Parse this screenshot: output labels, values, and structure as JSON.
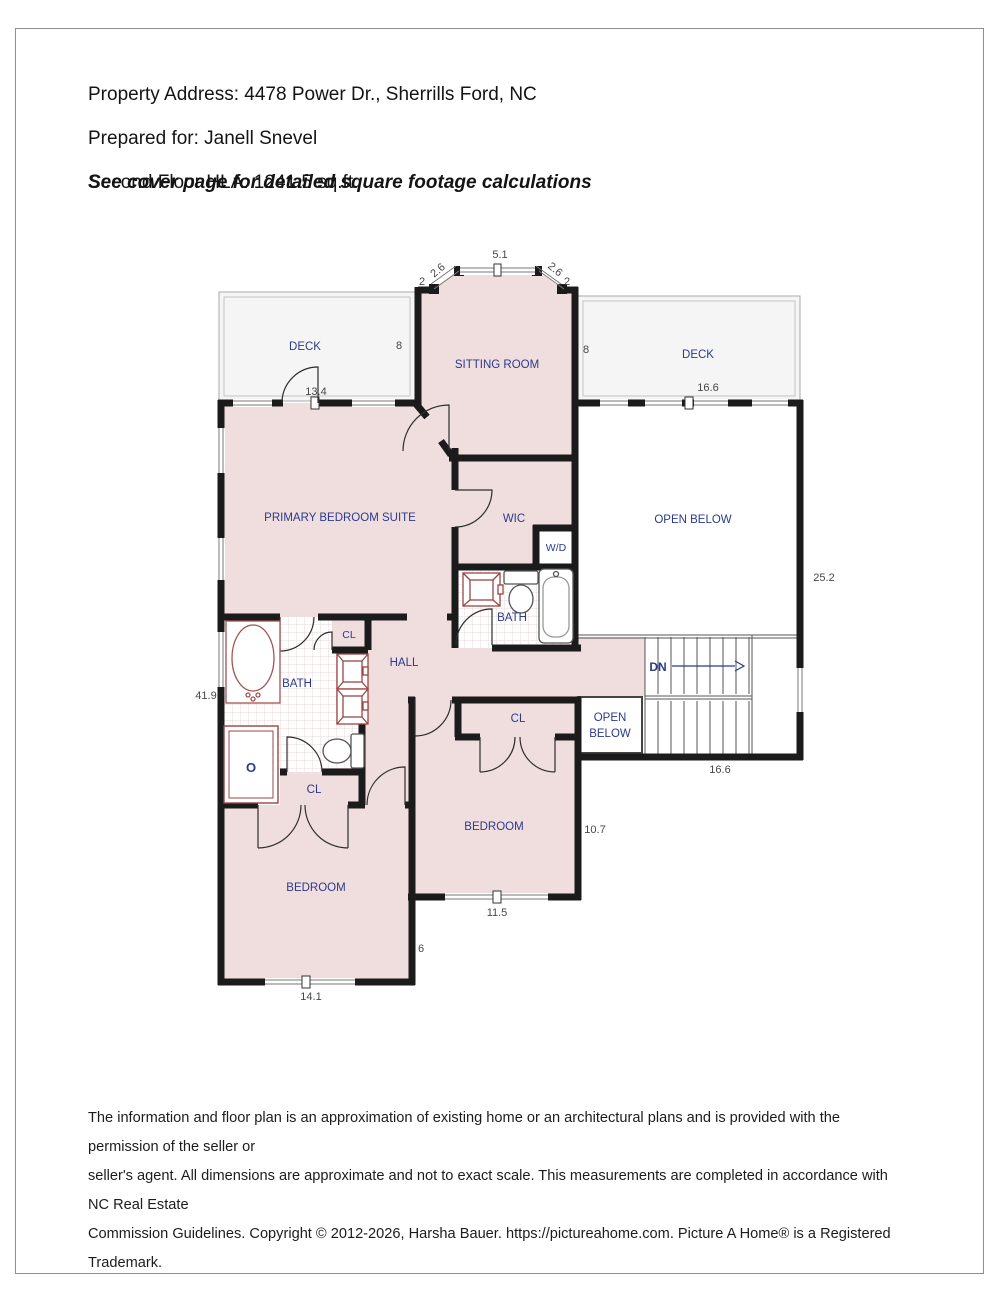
{
  "header": {
    "line1": "Property Address: 4478 Power Dr., Sherrills Ford, NC",
    "line2": "Prepared for: Janell Snevel",
    "line3": "Second Floor HLA: 1241.5 sq.ft.",
    "note": "See cover page for detailed square footage calculations"
  },
  "footer": {
    "line1": "The information and floor plan is an approximation of existing home or an architectural plans and is provided with the permission of the seller or",
    "line2": "seller's agent. All dimensions are approximate and not to exact scale.  This measurements are completed in accordance with NC Real Estate",
    "line3": "Commission Guidelines. Copyright © 2012-2026, Harsha Bauer. https://pictureahome.com. Picture A Home® is a Registered Trademark."
  },
  "floorplan": {
    "colors": {
      "room_fill": "#f0dede",
      "deck_fill": "#f5f5f5",
      "wall": "#1b1b1b",
      "room_label": "#2b3a8c",
      "dimension_label": "#474747",
      "fixture_accent": "#9b4444"
    },
    "room_labels": [
      {
        "id": "deck-left",
        "text": "DECK",
        "x": 305,
        "y": 350
      },
      {
        "id": "sitting-room",
        "text": "SITTING ROOM",
        "x": 497,
        "y": 368
      },
      {
        "id": "deck-right",
        "text": "DECK",
        "x": 698,
        "y": 358
      },
      {
        "id": "primary-bedroom-suite",
        "text": "PRIMARY BEDROOM SUITE",
        "x": 340,
        "y": 521
      },
      {
        "id": "wic",
        "text": "WIC",
        "x": 514,
        "y": 522
      },
      {
        "id": "wd",
        "text": "W/D",
        "x": 556,
        "y": 551,
        "size": 10.5
      },
      {
        "id": "open-below",
        "text": "OPEN BELOW",
        "x": 693,
        "y": 523
      },
      {
        "id": "bath-hall",
        "text": "BATH",
        "x": 512,
        "y": 621
      },
      {
        "id": "hall",
        "text": "HALL",
        "x": 404,
        "y": 666
      },
      {
        "id": "cl-bath",
        "text": "CL",
        "x": 349,
        "y": 638,
        "size": 10.5
      },
      {
        "id": "bath-primary",
        "text": "BATH",
        "x": 297,
        "y": 687
      },
      {
        "id": "dn",
        "text": "DN",
        "x": 658,
        "y": 671,
        "bold": true,
        "size": 12
      },
      {
        "id": "open-below-small-line1",
        "text": "OPEN",
        "x": 610,
        "y": 721
      },
      {
        "id": "open-below-small-line2",
        "text": "BELOW",
        "x": 610,
        "y": 737
      },
      {
        "id": "cl-bedroom-mid",
        "text": "CL",
        "x": 518,
        "y": 722
      },
      {
        "id": "cl-bedroom-left",
        "text": "CL",
        "x": 314,
        "y": 793
      },
      {
        "id": "bedroom-mid",
        "text": "BEDROOM",
        "x": 494,
        "y": 830
      },
      {
        "id": "bedroom-left",
        "text": "BEDROOM",
        "x": 316,
        "y": 891
      },
      {
        "id": "shower-drain",
        "text": "O",
        "x": 251,
        "y": 772,
        "color": "#9b4444",
        "bold": true,
        "size": 13
      }
    ],
    "dimension_labels": [
      {
        "id": "dim-bay-width",
        "text": "5.1",
        "x": 500,
        "y": 258
      },
      {
        "id": "dim-bay-diag-left",
        "text": "2.6",
        "x": 440,
        "y": 273,
        "rotate": -40
      },
      {
        "id": "dim-bay-diag-right",
        "text": "2.6",
        "x": 553,
        "y": 272,
        "rotate": 40
      },
      {
        "id": "dim-bay-stub-left",
        "text": "2",
        "x": 422,
        "y": 285
      },
      {
        "id": "dim-bay-stub-right",
        "text": "2",
        "x": 567,
        "y": 285
      },
      {
        "id": "dim-sitting-left",
        "text": "8",
        "x": 399,
        "y": 349
      },
      {
        "id": "dim-sitting-right",
        "text": "8",
        "x": 586,
        "y": 353
      },
      {
        "id": "dim-deck-left-width",
        "text": "13.4",
        "x": 316,
        "y": 395
      },
      {
        "id": "dim-deck-right-width",
        "text": "16.6",
        "x": 708,
        "y": 391
      },
      {
        "id": "dim-right-height",
        "text": "25.2",
        "x": 824,
        "y": 581
      },
      {
        "id": "dim-left-height",
        "text": "41.9",
        "x": 206,
        "y": 699
      },
      {
        "id": "dim-stairs-width",
        "text": "16.6",
        "x": 720,
        "y": 773
      },
      {
        "id": "dim-bedroom-mid-height",
        "text": "10.7",
        "x": 595,
        "y": 833
      },
      {
        "id": "dim-bedroom-mid-width",
        "text": "11.5",
        "x": 497,
        "y": 916
      },
      {
        "id": "dim-bedroom-left-height",
        "text": "6",
        "x": 421,
        "y": 952
      },
      {
        "id": "dim-bedroom-left-width",
        "text": "14.1",
        "x": 311,
        "y": 1000
      }
    ]
  }
}
